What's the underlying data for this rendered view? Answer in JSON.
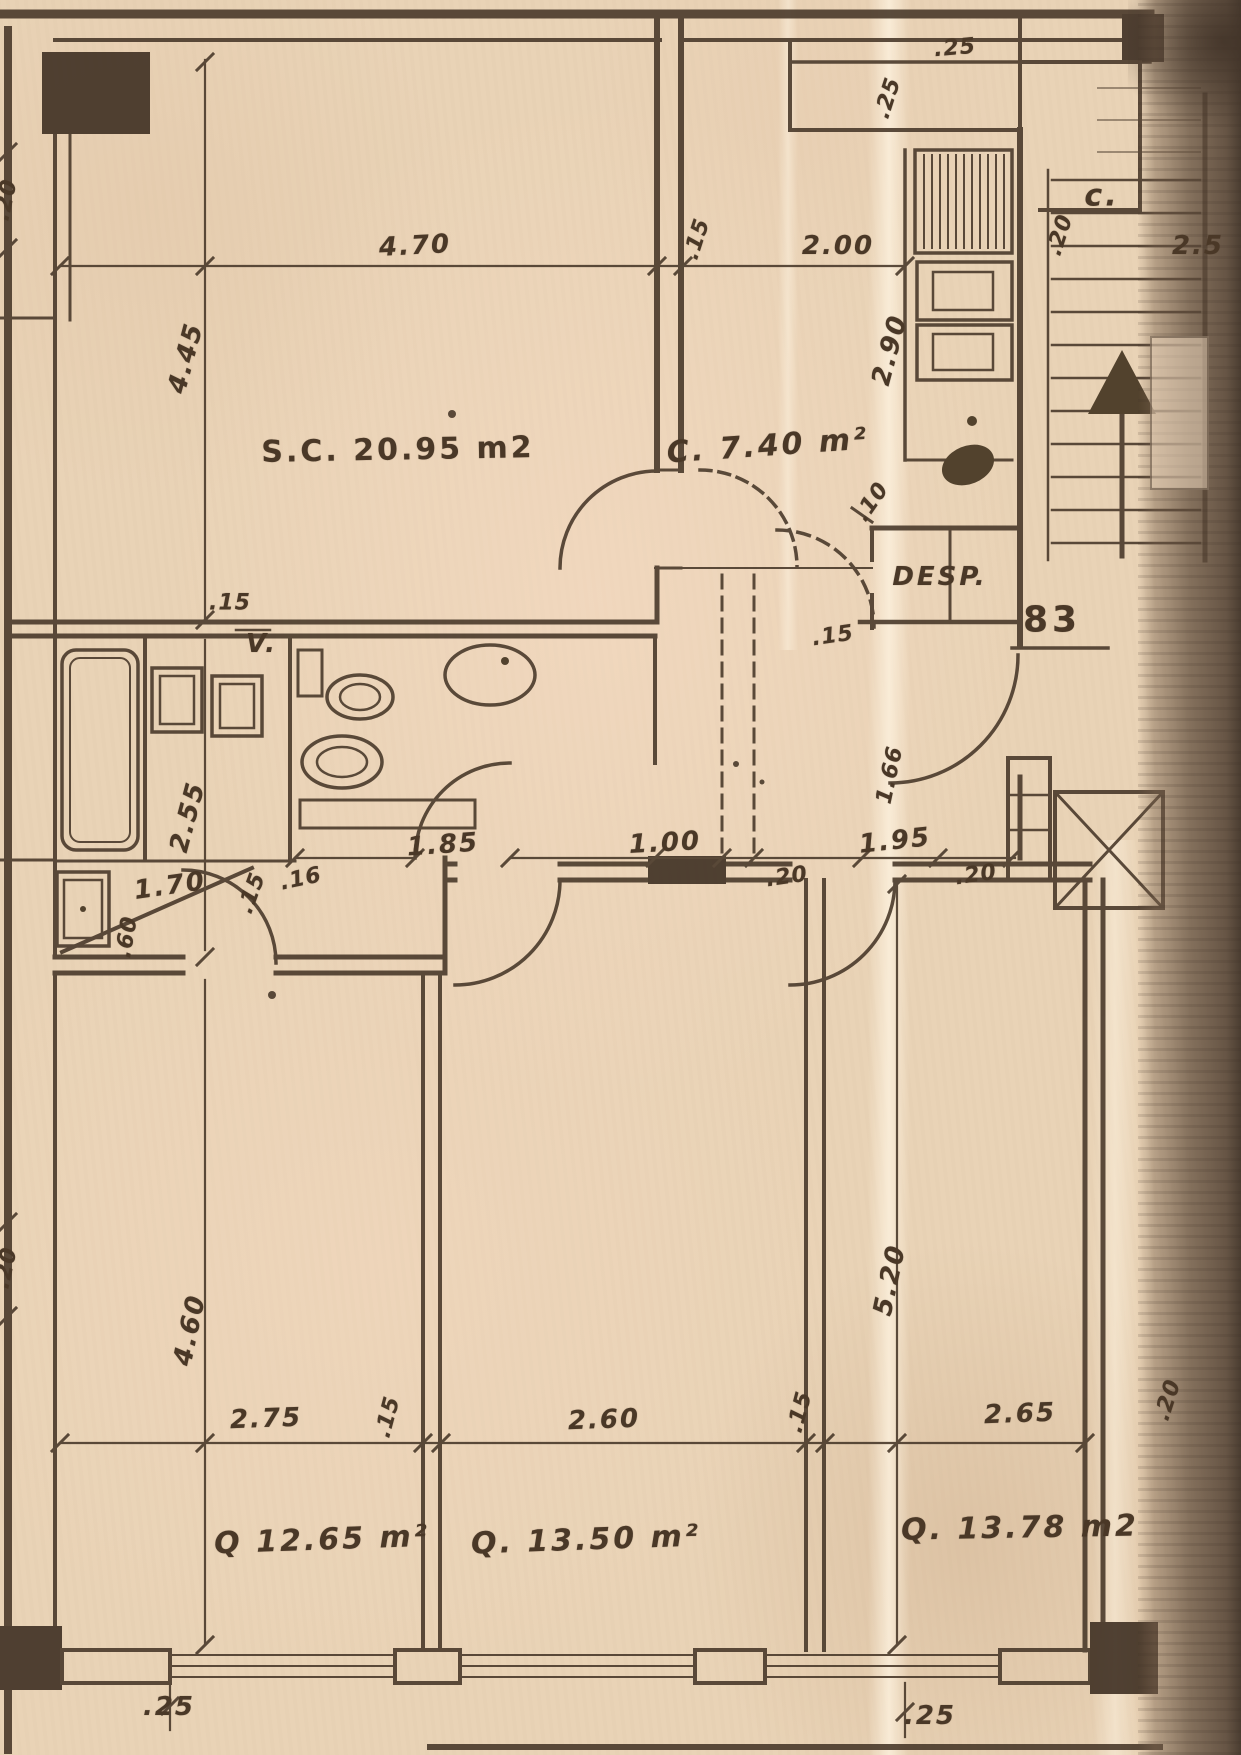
{
  "document": {
    "kind": "Scanned apartment floor-plan blueprint",
    "sheet_number": "83"
  },
  "colors": {
    "paper": "#e9d3b6",
    "ink": "#4a3827",
    "scan_edge": "#6d5947",
    "streak": "#fdf2df"
  },
  "rooms": {
    "living": "S.C. 20.95 m2",
    "kitchen": "C. 7.40 m²",
    "pantry": "DESP.",
    "closet": "c.",
    "vent_shaft": "V.",
    "bedroom1": "Q 12.65 m²",
    "bedroom2": "Q. 13.50 m²",
    "bedroom3": "Q. 13.78 m2"
  },
  "dims": {
    "living_width": "4.70",
    "top_wall": ".15",
    "corridor_width": "2.00",
    "kitchen_top_wall": ".25",
    "kitchen_side_wall": ".25",
    "closet_wall": ".20",
    "stair_width": "2.5",
    "living_depth": "4.45",
    "counter_length": "2.90",
    "pantry_jamb": ".10",
    "pantry_bottom_wall": ".15",
    "bath_top_wall": ".15",
    "bath_depth": "2.55",
    "bath_width": "1.85",
    "hall_width": "1.00",
    "vestibule_depth": "1.66",
    "vestibule_width": "1.95",
    "vestibule_jamb_left": ".20",
    "vestibule_jamb_right": ".20",
    "lobby_width": "1.70",
    "lobby_jamb": ".15",
    "lobby_jamb2": ".16",
    "lobby_door": ".60",
    "bedroom1_depth": "4.60",
    "bedroom3_depth": "5.20",
    "bedroom1_width": "2.75",
    "wall_12": ".15",
    "bedroom2_width": "2.60",
    "wall_23": ".15",
    "bedroom3_width": "2.65",
    "bedroom3_side_wall": ".20",
    "sill_left": ".25",
    "sill_right": ".25",
    "left_wall_upper": ".20",
    "left_wall_lower": ".20"
  }
}
